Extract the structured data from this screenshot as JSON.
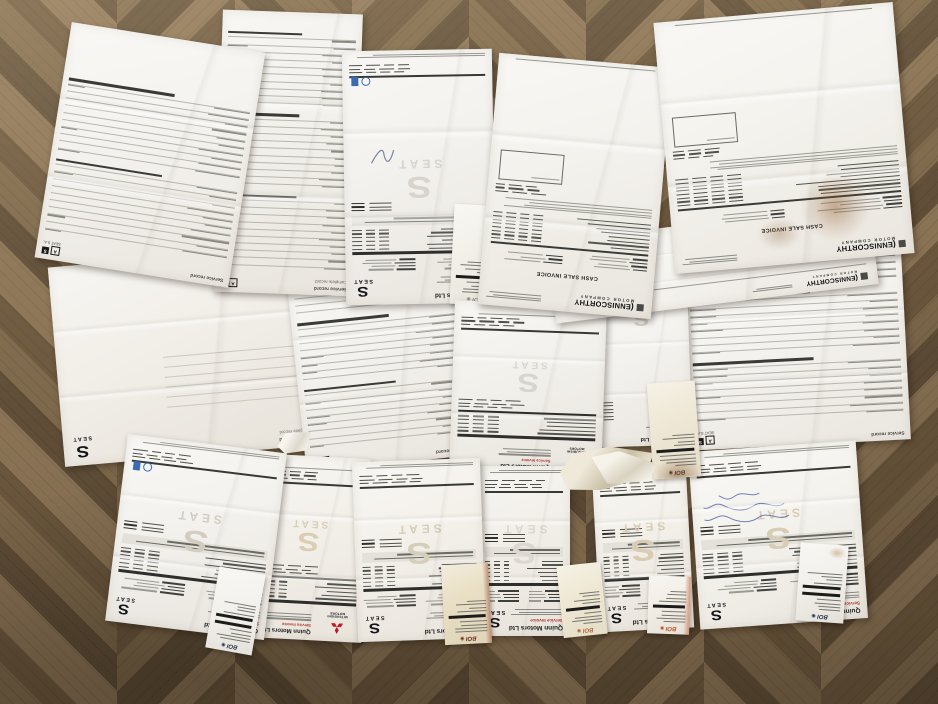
{
  "brands": {
    "quinn": "Quinn Motors Ltd",
    "service_invoice": "Service Invoice",
    "seat_wordmark": "SEAT",
    "mitsubishi": "MITSUBISHI MOTORS",
    "enniscorthy": "ENNISCORTHY",
    "motor_company": "MOTOR COMPANY",
    "cash_sale_invoice": "CASH SALE INVOICE",
    "boi": "BOI"
  },
  "labels": {
    "service_record": "Service record",
    "complete_record": "Complete record",
    "seat_sa": "SEAT S.A."
  },
  "icons": {
    "seat_s": "S",
    "boi_circle": "◉",
    "record_a": "A",
    "record_s": "S",
    "swoosh": "("
  },
  "colors": {
    "red_label": "#b3342c",
    "blue_stamp": "#3a6cb4",
    "mitsubishi_red": "#c01820",
    "ink_blue": "#3a4fa0",
    "floor_palette": [
      "#7d684b",
      "#6b573d",
      "#8a7355",
      "#5f4d37"
    ],
    "floor_grain": "rgba(30,20,10,0.10)"
  },
  "floor": {
    "columns": 8,
    "col_width": 118,
    "stripe_stops": [
      30,
      54,
      92,
      118
    ]
  },
  "sheets": [
    {
      "id": "p6",
      "kind": "blank",
      "l": 56,
      "t": 256,
      "w": 258,
      "h": 200,
      "rot": -5,
      "bg": "#f2efe9"
    },
    {
      "id": "p7",
      "kind": "record",
      "l": 296,
      "t": 268,
      "w": 170,
      "h": 196,
      "rot": -6,
      "bg": "#f4f2ee",
      "groups": 3,
      "rows": 8
    },
    {
      "id": "p10",
      "kind": "record",
      "l": 686,
      "t": 253,
      "w": 220,
      "h": 192,
      "rot": -3,
      "bg": "#f5f3ef",
      "groups": 3,
      "rows": 8,
      "sa": true
    },
    {
      "id": "p2",
      "kind": "record",
      "l": 218,
      "t": 12,
      "w": 140,
      "h": 282,
      "rot": 2,
      "bg": "#f3f1ec",
      "groups": 3,
      "rows": 10,
      "complete": true
    },
    {
      "id": "p1",
      "kind": "record",
      "l": 52,
      "t": 36,
      "w": 196,
      "h": 238,
      "rot": 9,
      "bg": "#f5f3ef",
      "groups": 2,
      "rows": 10,
      "sa": true
    },
    {
      "id": "p3",
      "kind": "seat",
      "l": 344,
      "t": 50,
      "w": 150,
      "h": 254,
      "rot": -1,
      "bg": "#f4f2ee",
      "wm": "#d7d4cd",
      "stamps": true,
      "squiggle": true
    },
    {
      "id": "r6",
      "kind": "receipt",
      "l": 452,
      "t": 205,
      "w": 50,
      "h": 100,
      "rot": 3,
      "bg": "#f3f1ea",
      "logo": "#8a8a82",
      "bars": 1
    },
    {
      "id": "p9",
      "kind": "frag",
      "l": 596,
      "t": 294,
      "w": 94,
      "h": 152,
      "rot": -2,
      "bg": "#f4f2ee",
      "wm": "#d5d2ca"
    },
    {
      "id": "p8",
      "kind": "mitsu",
      "l": 452,
      "t": 303,
      "w": 152,
      "h": 172,
      "rot": 2,
      "bg": "#f3f1ec",
      "wm": "#d8d5ce"
    },
    {
      "id": "p5b",
      "kind": "strip",
      "l": 550,
      "t": 222,
      "w": 325,
      "h": 82,
      "rot": -7,
      "bg": "#f6f4f0"
    },
    {
      "id": "p4",
      "kind": "cash",
      "l": 488,
      "t": 60,
      "w": 174,
      "h": 252,
      "rot": 5,
      "bg": "#f4f2ed"
    },
    {
      "id": "p5",
      "kind": "cash",
      "l": 664,
      "t": 12,
      "w": 240,
      "h": 252,
      "rot": -5,
      "bg": "#f5f3ee",
      "stain": true
    },
    {
      "id": "p12",
      "kind": "mitsu",
      "l": 250,
      "t": 456,
      "w": 116,
      "h": 184,
      "rot": 3,
      "bg": "#f3f0ea",
      "wm": "#d9cdb2"
    },
    {
      "id": "p11",
      "kind": "seat",
      "l": 116,
      "t": 443,
      "w": 160,
      "h": 188,
      "rot": 7,
      "bg": "#f4f2ee",
      "wm": "#d2ccc1",
      "stamps": true
    },
    {
      "id": "p14",
      "kind": "seat",
      "l": 478,
      "t": 466,
      "w": 92,
      "h": 170,
      "rot": 0,
      "bg": "#f2efe9",
      "wm": "#dcd8d0"
    },
    {
      "id": "p13",
      "kind": "seat",
      "l": 355,
      "t": 460,
      "w": 128,
      "h": 180,
      "rot": -2,
      "bg": "#f4f1eb",
      "wm": "#d5cfba"
    },
    {
      "id": "p14b",
      "kind": "seat",
      "l": 596,
      "t": 468,
      "w": 94,
      "h": 162,
      "rot": -3,
      "bg": "#f3f0ea",
      "wm": "#d8ccb2"
    },
    {
      "id": "p15",
      "kind": "seat",
      "l": 694,
      "t": 446,
      "w": 168,
      "h": 178,
      "rot": -4,
      "bg": "#f5f3ee",
      "wm": "#d8cdb4",
      "hand": true
    },
    {
      "id": "rmid",
      "kind": "receipt",
      "l": 650,
      "t": 382,
      "w": 48,
      "h": 96,
      "rot": -4,
      "bg": "#efe8d6",
      "logo": "#3a3a38",
      "bars": 1,
      "stainB": true
    },
    {
      "id": "r0",
      "kind": "receipt",
      "l": 212,
      "t": 570,
      "w": 47,
      "h": 82,
      "rot": 10,
      "bg": "#f4f2ee",
      "logo": "#23304e",
      "bars": 2
    },
    {
      "id": "r2",
      "kind": "receipt",
      "l": 443,
      "t": 564,
      "w": 47,
      "h": 80,
      "rot": -3,
      "bg": "#e9dfc4",
      "logo": "#6e2c1c",
      "bars": 1,
      "stainR": "#9c4a28"
    },
    {
      "id": "r3",
      "kind": "receipt",
      "l": 560,
      "t": 564,
      "w": 44,
      "h": 72,
      "rot": -6,
      "bg": "#efe9d4",
      "logo": "#b06838",
      "bars": 1
    },
    {
      "id": "r4",
      "kind": "receipt",
      "l": 648,
      "t": 576,
      "w": 42,
      "h": 58,
      "rot": 2,
      "bg": "#f2efe7",
      "logo": "#c4502a",
      "bars": 1,
      "stainR": "#c4502a"
    },
    {
      "id": "r5",
      "kind": "receipt",
      "l": 798,
      "t": 544,
      "w": 48,
      "h": 78,
      "rot": 4,
      "bg": "#f3f1ec",
      "logo": "#1d2742",
      "bars": 2,
      "stainT": true
    },
    {
      "id": "s1",
      "kind": "scrap",
      "l": 560,
      "t": 447,
      "w": 95,
      "h": 42,
      "rot": -8,
      "bg1": "#efe9da",
      "bg2": "#c9bfa6",
      "clip": "polygon(0% 45%, 16% 5%, 55% 0%, 100% 30%, 88% 85%, 40% 100%, 6% 88%)"
    },
    {
      "id": "s2",
      "kind": "scrap",
      "l": 590,
      "t": 452,
      "w": 66,
      "h": 34,
      "rot": 9,
      "bg1": "#f6f3ea",
      "bg2": "#d8d2c0",
      "clip": "polygon(0% 30%, 40% 0%, 100% 20%, 92% 75%, 30% 100%)"
    },
    {
      "id": "s3",
      "kind": "scrap",
      "l": 277,
      "t": 431,
      "w": 36,
      "h": 22,
      "rot": -14,
      "bg1": "#f6f4ef",
      "bg2": "#ddd8cc",
      "clip": "polygon(0% 50%, 30% 0%, 100% 25%, 75% 100%, 15% 90%)"
    }
  ]
}
